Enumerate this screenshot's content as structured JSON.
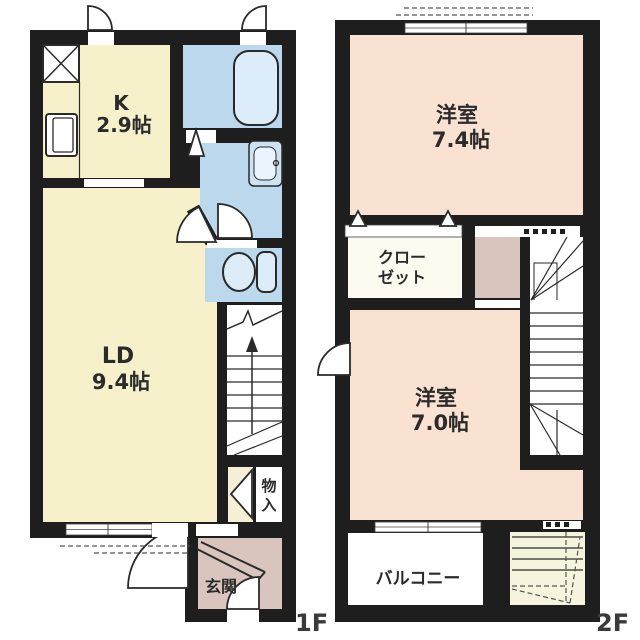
{
  "floor_1f": {
    "floor_label": "1F",
    "kitchen": {
      "label": "K",
      "area": "2.9帖"
    },
    "living_dining": {
      "label": "LD",
      "area": "9.4帖"
    },
    "entrance": {
      "label": "玄関"
    },
    "storage": {
      "char_1": "物",
      "char_2": "入"
    }
  },
  "floor_2f": {
    "floor_label": "2F",
    "bedroom_74": {
      "label": "洋室",
      "area": "7.4帖"
    },
    "closet": {
      "line_1": "クロー",
      "line_2": "ゼット"
    },
    "bedroom_70": {
      "label": "洋室",
      "area": "7.0帖"
    },
    "balcony": {
      "label": "バルコニー"
    }
  },
  "fixtures": {
    "bathtub": "rounded-rectangle",
    "washbasin": "rect-with-faucet-circle",
    "toilet": "bowl-ellipse-with-tank",
    "refrigerator_space": "x-crossed-box",
    "kitchen_unit": "double-rectangle",
    "stair_direction": "up-arrow",
    "doors": "quarter-circle-swings",
    "folding_doors": "triangle-markers"
  },
  "colors": {
    "wall": "#1e1e1e",
    "kitchen_living": "#f6f1ca",
    "wet_rooms": "#bcd8ed",
    "fixture_fill": "#dcecf8",
    "bedrooms": "#f9e2d2",
    "entrance_hall": "#d9c5bd",
    "closet": "#fdfaef",
    "understair_closet": "#f4efd5",
    "void_room": "#f7f4de",
    "balcony": "#ffffff",
    "text": "#2b2b2b"
  }
}
